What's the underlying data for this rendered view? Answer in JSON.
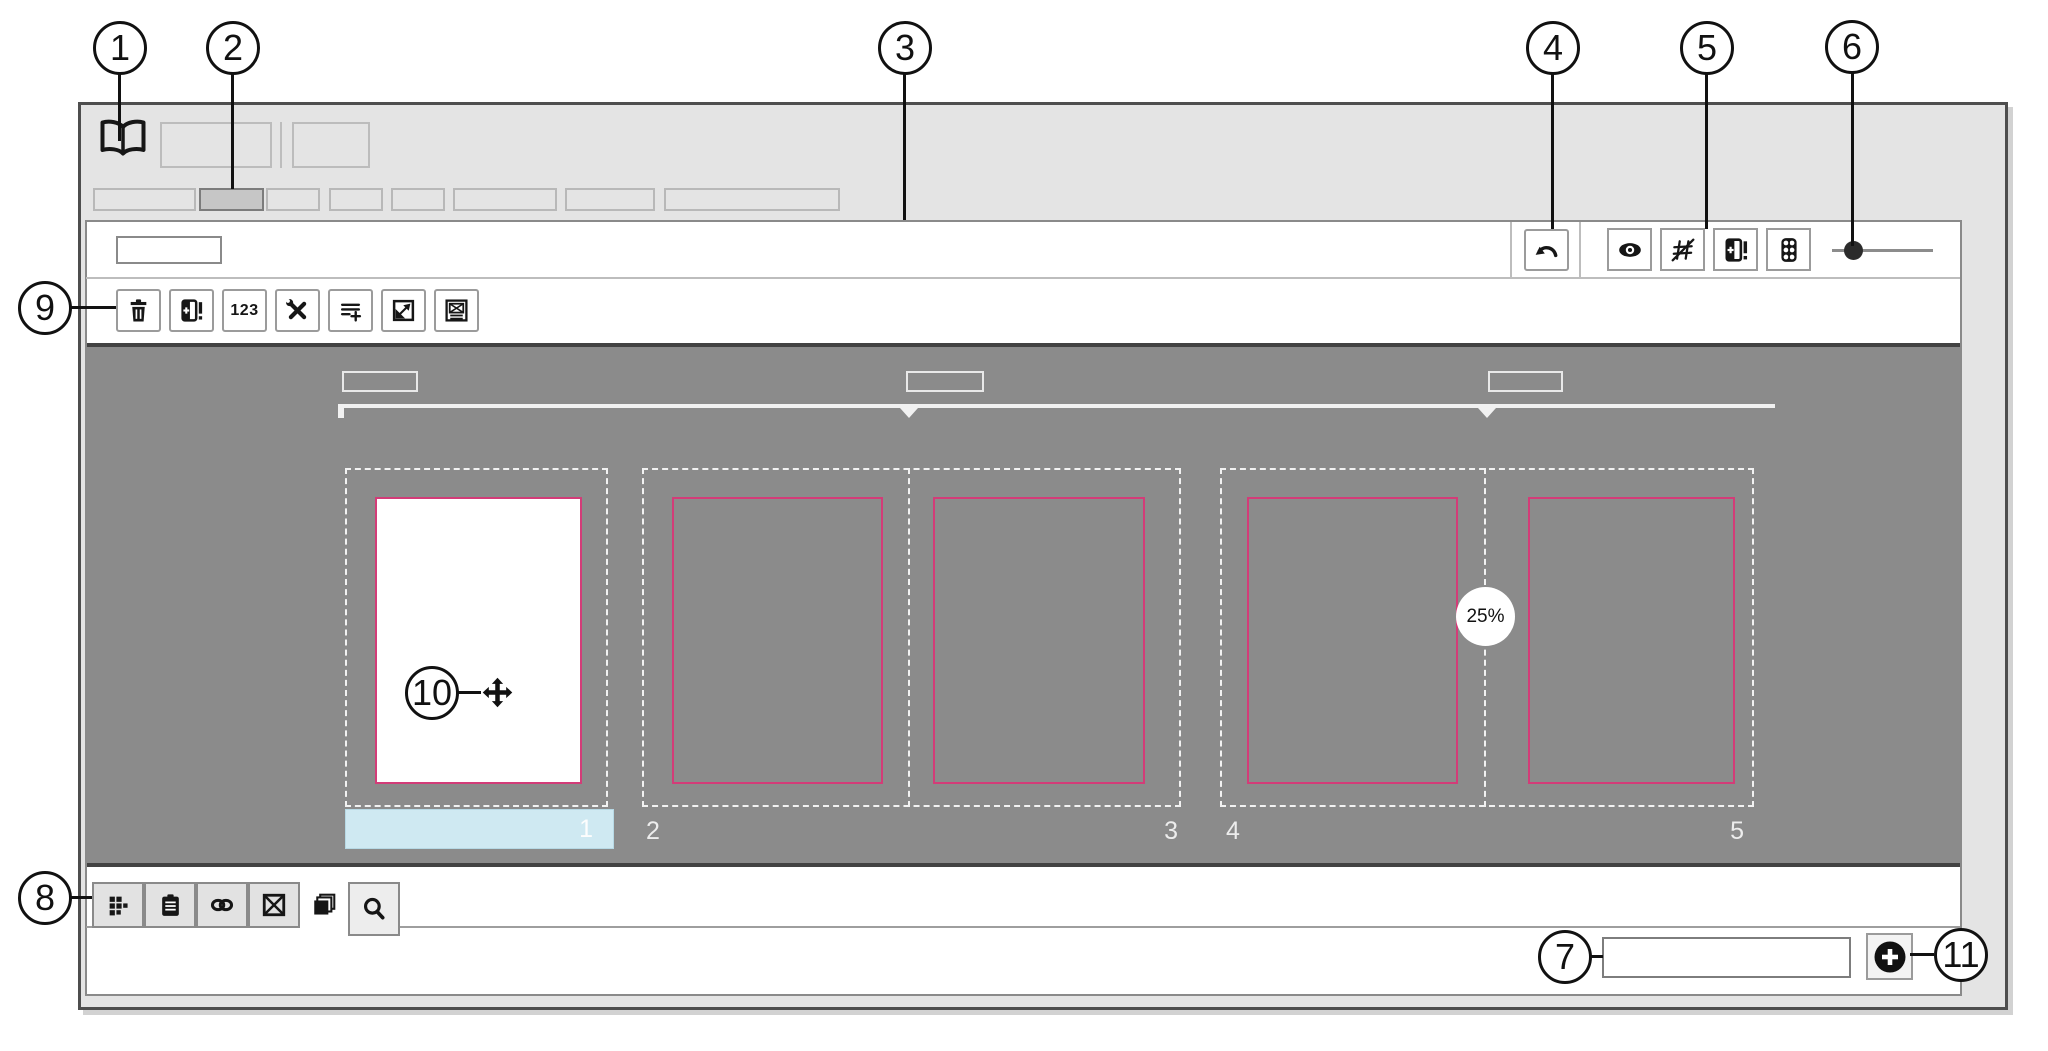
{
  "diagram": {
    "callouts": [
      {
        "num": "1",
        "target": "book-icon"
      },
      {
        "num": "2",
        "target": "active-document-tab"
      },
      {
        "num": "3",
        "target": "pages-panel"
      },
      {
        "num": "4",
        "target": "undo-button"
      },
      {
        "num": "5",
        "target": "grid-overlay-button"
      },
      {
        "num": "6",
        "target": "zoom-slider"
      },
      {
        "num": "7",
        "target": "footer-text-input"
      },
      {
        "num": "8",
        "target": "panel-tab-bar"
      },
      {
        "num": "9",
        "target": "pages-toolbar"
      },
      {
        "num": "10",
        "target": "move-cursor"
      },
      {
        "num": "11",
        "target": "add-button"
      }
    ]
  },
  "header": {
    "icons": [
      "book-icon"
    ]
  },
  "top_right_toolbar": {
    "icons": [
      "undo-icon",
      "eye-icon",
      "grid-slash-icon",
      "page-options-icon",
      "traffic-light-icon",
      "zoom-slider"
    ]
  },
  "toolbar": {
    "numbering_label": "123",
    "icons": [
      "trash-icon",
      "add-page-icon",
      "numbering-icon",
      "tools-icon",
      "add-list-icon",
      "resize-icon",
      "image-frame-icon"
    ]
  },
  "pages_panel": {
    "zoom_badge": "25%",
    "page_numbers": [
      "1",
      "2",
      "3",
      "4",
      "5"
    ],
    "selected_page": "1"
  },
  "bottom_tabs": {
    "icons": [
      "grid-icon",
      "clipboard-icon",
      "link-icon",
      "placeholder-icon",
      "layers-icon",
      "search-icon"
    ]
  },
  "colors": {
    "page_border_pink": "#d33c78",
    "selected_bar_cyan": "#cfe9f2",
    "canvas_gray": "#8b8b8b"
  }
}
